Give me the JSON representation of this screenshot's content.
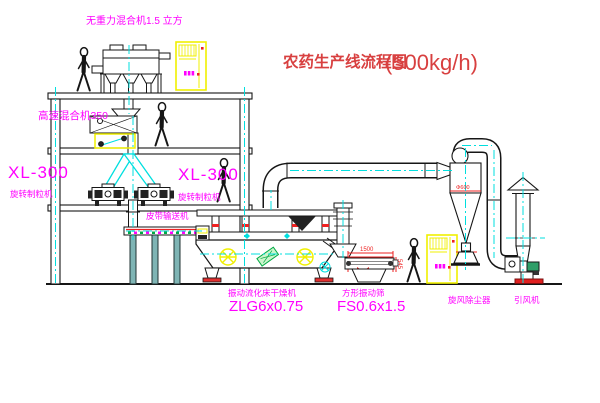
{
  "title": {
    "name": "农药生产线流程图",
    "capacity": "(500kg/h)"
  },
  "equipment_labels": {
    "gravity_mixer": "无重力混合机1.5 立方",
    "high_speed_mixer": "高速混合机350",
    "granulator_left_model": "XL-300",
    "granulator_left_name": "旋转制粒机",
    "granulator_right_model": "XL-300",
    "granulator_right_name": "旋转制粒机",
    "belt_conveyor": "皮带输送机",
    "fluid_bed_dryer_name": "振动流化床干燥机",
    "fluid_bed_dryer_model": "ZLG6x0.75",
    "vibrating_sieve_name": "方形振动筛",
    "vibrating_sieve_model": "FS0.6x1.5",
    "cyclone": "旋风除尘器",
    "induced_draft_fan": "引风机"
  },
  "dimensions": {
    "sieve_length": "1500",
    "sieve_height": "545",
    "cyclone_note": "Φ600"
  },
  "colors": {
    "label_magenta": "#ff00ff",
    "title_red": "#d84040",
    "dimension_red": "#ee2222",
    "centerline_cyan": "#00dfdf",
    "equipment_yellow": "#f0f000",
    "line_black": "#161616",
    "tag_green": "#00aa44"
  }
}
